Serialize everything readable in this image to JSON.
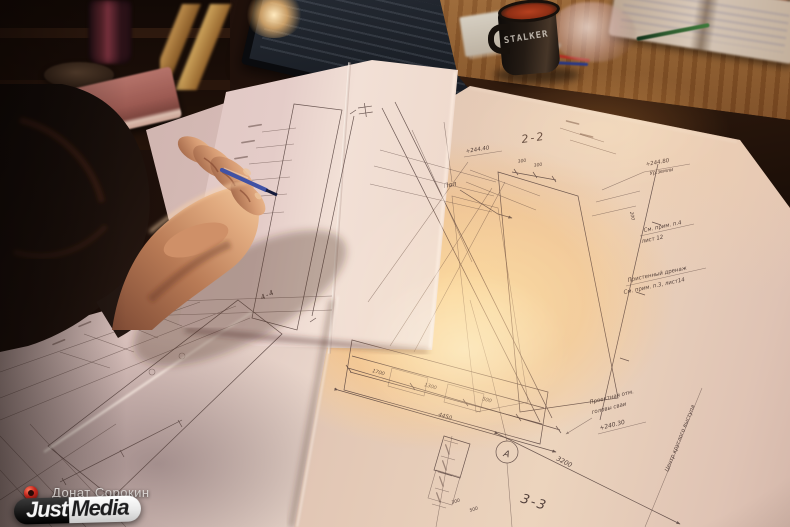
{
  "watermark": {
    "credit": "Донат Сорокин",
    "logo_first": "Just",
    "logo_second": "Media"
  },
  "mug_text": "STALKER",
  "blueprint_labels": {
    "section_22": "2-2",
    "section_33": "3-3",
    "section_44": "4-4",
    "axis_a": "А",
    "floor": "Пол",
    "elev_top": "+244.40",
    "elev_ground": "+244.80",
    "ground_level": "Ур.земли",
    "note_p4_line1": "См. прим. п.4",
    "note_p4_line2": "лист 12",
    "drainage_line1": "Пристенный дренаж",
    "drainage_line2": "См. прим. п.3, лист14",
    "proj_line1": "Проектная отм.",
    "proj_line2": "головы сваи",
    "elev_pile": "+240.30",
    "ledge_center": "Центр круглого выступа"
  },
  "dimensions": {
    "d3200": "3200",
    "d4450": "4450",
    "d1700": "1700",
    "d1300": "1300",
    "d500": "500",
    "d300": "300",
    "d200": "200"
  },
  "colors": {
    "logo_red": "#c5271d",
    "pen_blue": "#4052a5",
    "sunlight": "#ffb066",
    "paper_pink": "#e6ccbc",
    "desk_wood": "#8a5a30",
    "mug_interior": "#b5401f"
  }
}
